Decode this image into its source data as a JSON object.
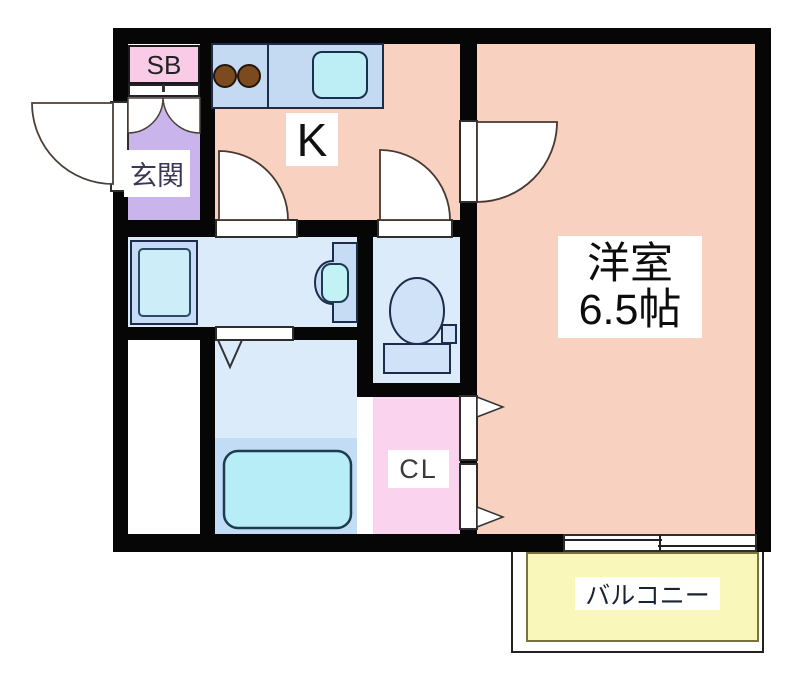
{
  "floorplan": {
    "rooms": {
      "shoe_box": {
        "label": "SB"
      },
      "entrance": {
        "label": "玄関"
      },
      "kitchen": {
        "label": "K"
      },
      "western_room": {
        "label": "洋室",
        "size": "6.5帖"
      },
      "closet": {
        "label": "CL"
      },
      "balcony": {
        "label": "バルコニー"
      }
    },
    "colors": {
      "wall": "#060606",
      "room_salmon": "#f9d1c1",
      "entrance_purple": "#c9b5eb",
      "shoe_box_pink": "#f9cbe7",
      "closet_pink": "#fad4ef",
      "wet_area_blue": "#dcebfa",
      "fixture_blue": "#c6dcf5",
      "fixture_cyan": "#b6edf6",
      "counter_blue": "#c4daf3",
      "tub_surround_blue": "#c3dcf5",
      "burner_brown": "#7c4a1f",
      "balcony_yellow": "#faf7bb"
    }
  }
}
